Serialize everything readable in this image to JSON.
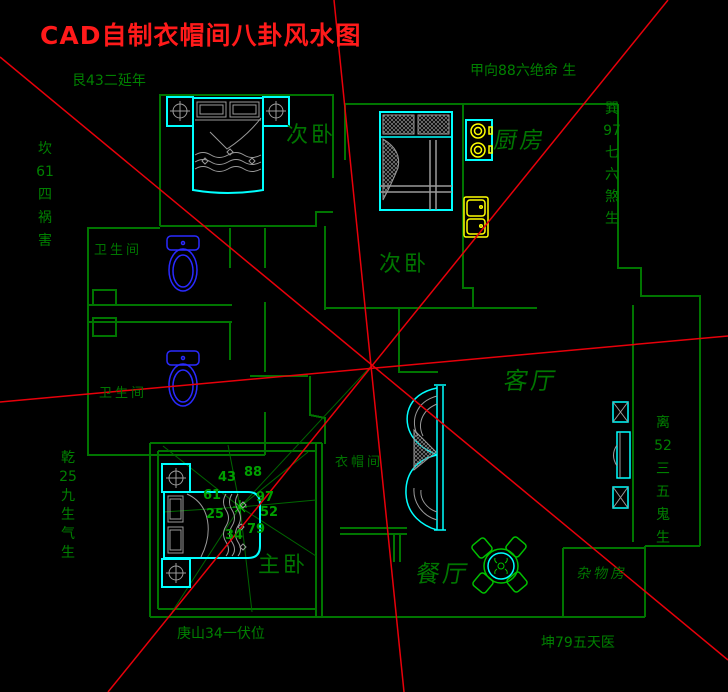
{
  "title": "CAD自制衣帽间八卦风水图",
  "colors": {
    "background": "#000000",
    "red_line": "#e8000a",
    "title_red": "#ff1a1a",
    "wall_green": "#007500",
    "label_green": "#008000",
    "number_green": "#00a000",
    "furniture_cyan": "#00ffff",
    "fixture_blue": "#2a2aff",
    "appliance_yellow": "#ffff00",
    "detail_gray": "#9a9a9a",
    "dining_green": "#00c000"
  },
  "labels_horizontal": [
    {
      "name": "bagua-label-gen",
      "text": "艮43二延年",
      "x": 72,
      "y": 74,
      "size": 14,
      "cls": "green"
    },
    {
      "name": "bagua-label-jia",
      "text": "甲向88六绝命 生",
      "x": 470,
      "y": 64,
      "size": 14,
      "cls": "green"
    },
    {
      "name": "bagua-label-kun",
      "text": "坤79五天医",
      "x": 541,
      "y": 636,
      "size": 14,
      "cls": "green"
    },
    {
      "name": "bagua-label-geng",
      "text": "庚山34一伏位",
      "x": 177,
      "y": 627,
      "size": 14,
      "cls": "green"
    },
    {
      "name": "room-label-bedroom-top",
      "text": "次卧",
      "x": 286,
      "y": 124,
      "size": 22,
      "cls": "room"
    },
    {
      "name": "room-label-kitchen",
      "text": "厨房",
      "x": 494,
      "y": 129,
      "size": 23,
      "cls": "room slant"
    },
    {
      "name": "room-label-bedroom-middle",
      "text": "次卧",
      "x": 379,
      "y": 253,
      "size": 22,
      "cls": "room"
    },
    {
      "name": "room-label-bathroom-1",
      "text": "卫生间",
      "x": 94,
      "y": 244,
      "size": 13,
      "cls": "room"
    },
    {
      "name": "room-label-bathroom-2",
      "text": "卫生间",
      "x": 99,
      "y": 387,
      "size": 13,
      "cls": "room"
    },
    {
      "name": "room-label-living",
      "text": "客厅",
      "x": 504,
      "y": 368,
      "size": 24,
      "cls": "room slant"
    },
    {
      "name": "room-label-cloakroom",
      "text": "衣帽间",
      "x": 335,
      "y": 456,
      "size": 13,
      "cls": "room"
    },
    {
      "name": "room-label-master",
      "text": "主卧",
      "x": 258,
      "y": 554,
      "size": 22,
      "cls": "room"
    },
    {
      "name": "room-label-dining",
      "text": "餐厅",
      "x": 416,
      "y": 561,
      "size": 24,
      "cls": "room slant"
    },
    {
      "name": "room-label-storage",
      "text": "杂物房",
      "x": 577,
      "y": 567,
      "size": 14,
      "cls": "room slant"
    }
  ],
  "mini_bagua_numbers": [
    {
      "text": "43",
      "x": 218,
      "y": 471
    },
    {
      "text": "88",
      "x": 244,
      "y": 466
    },
    {
      "text": "61",
      "x": 203,
      "y": 489
    },
    {
      "text": "97",
      "x": 256,
      "y": 491
    },
    {
      "text": "25",
      "x": 206,
      "y": 508
    },
    {
      "text": "52",
      "x": 260,
      "y": 506
    },
    {
      "text": "79",
      "x": 247,
      "y": 523
    },
    {
      "text": "34",
      "x": 225,
      "y": 529
    }
  ],
  "labels_vertical": [
    {
      "name": "bagua-label-kan",
      "lines": [
        "坎",
        "61",
        "四",
        "祸",
        "害"
      ],
      "x": 34,
      "y": 138,
      "size": 14,
      "lh": 23
    },
    {
      "name": "bagua-label-xun",
      "lines": [
        "巽",
        "97",
        "七",
        "六",
        "煞",
        "生"
      ],
      "x": 601,
      "y": 98,
      "size": 14,
      "lh": 22
    },
    {
      "name": "bagua-label-qian",
      "lines": [
        "乾",
        "25",
        "九",
        "生",
        "气",
        "生"
      ],
      "x": 57,
      "y": 449,
      "size": 14,
      "lh": 19
    },
    {
      "name": "bagua-label-li",
      "lines": [
        "离",
        "52",
        "三",
        "五",
        "鬼",
        "生"
      ],
      "x": 652,
      "y": 412,
      "size": 14,
      "lh": 23
    }
  ]
}
